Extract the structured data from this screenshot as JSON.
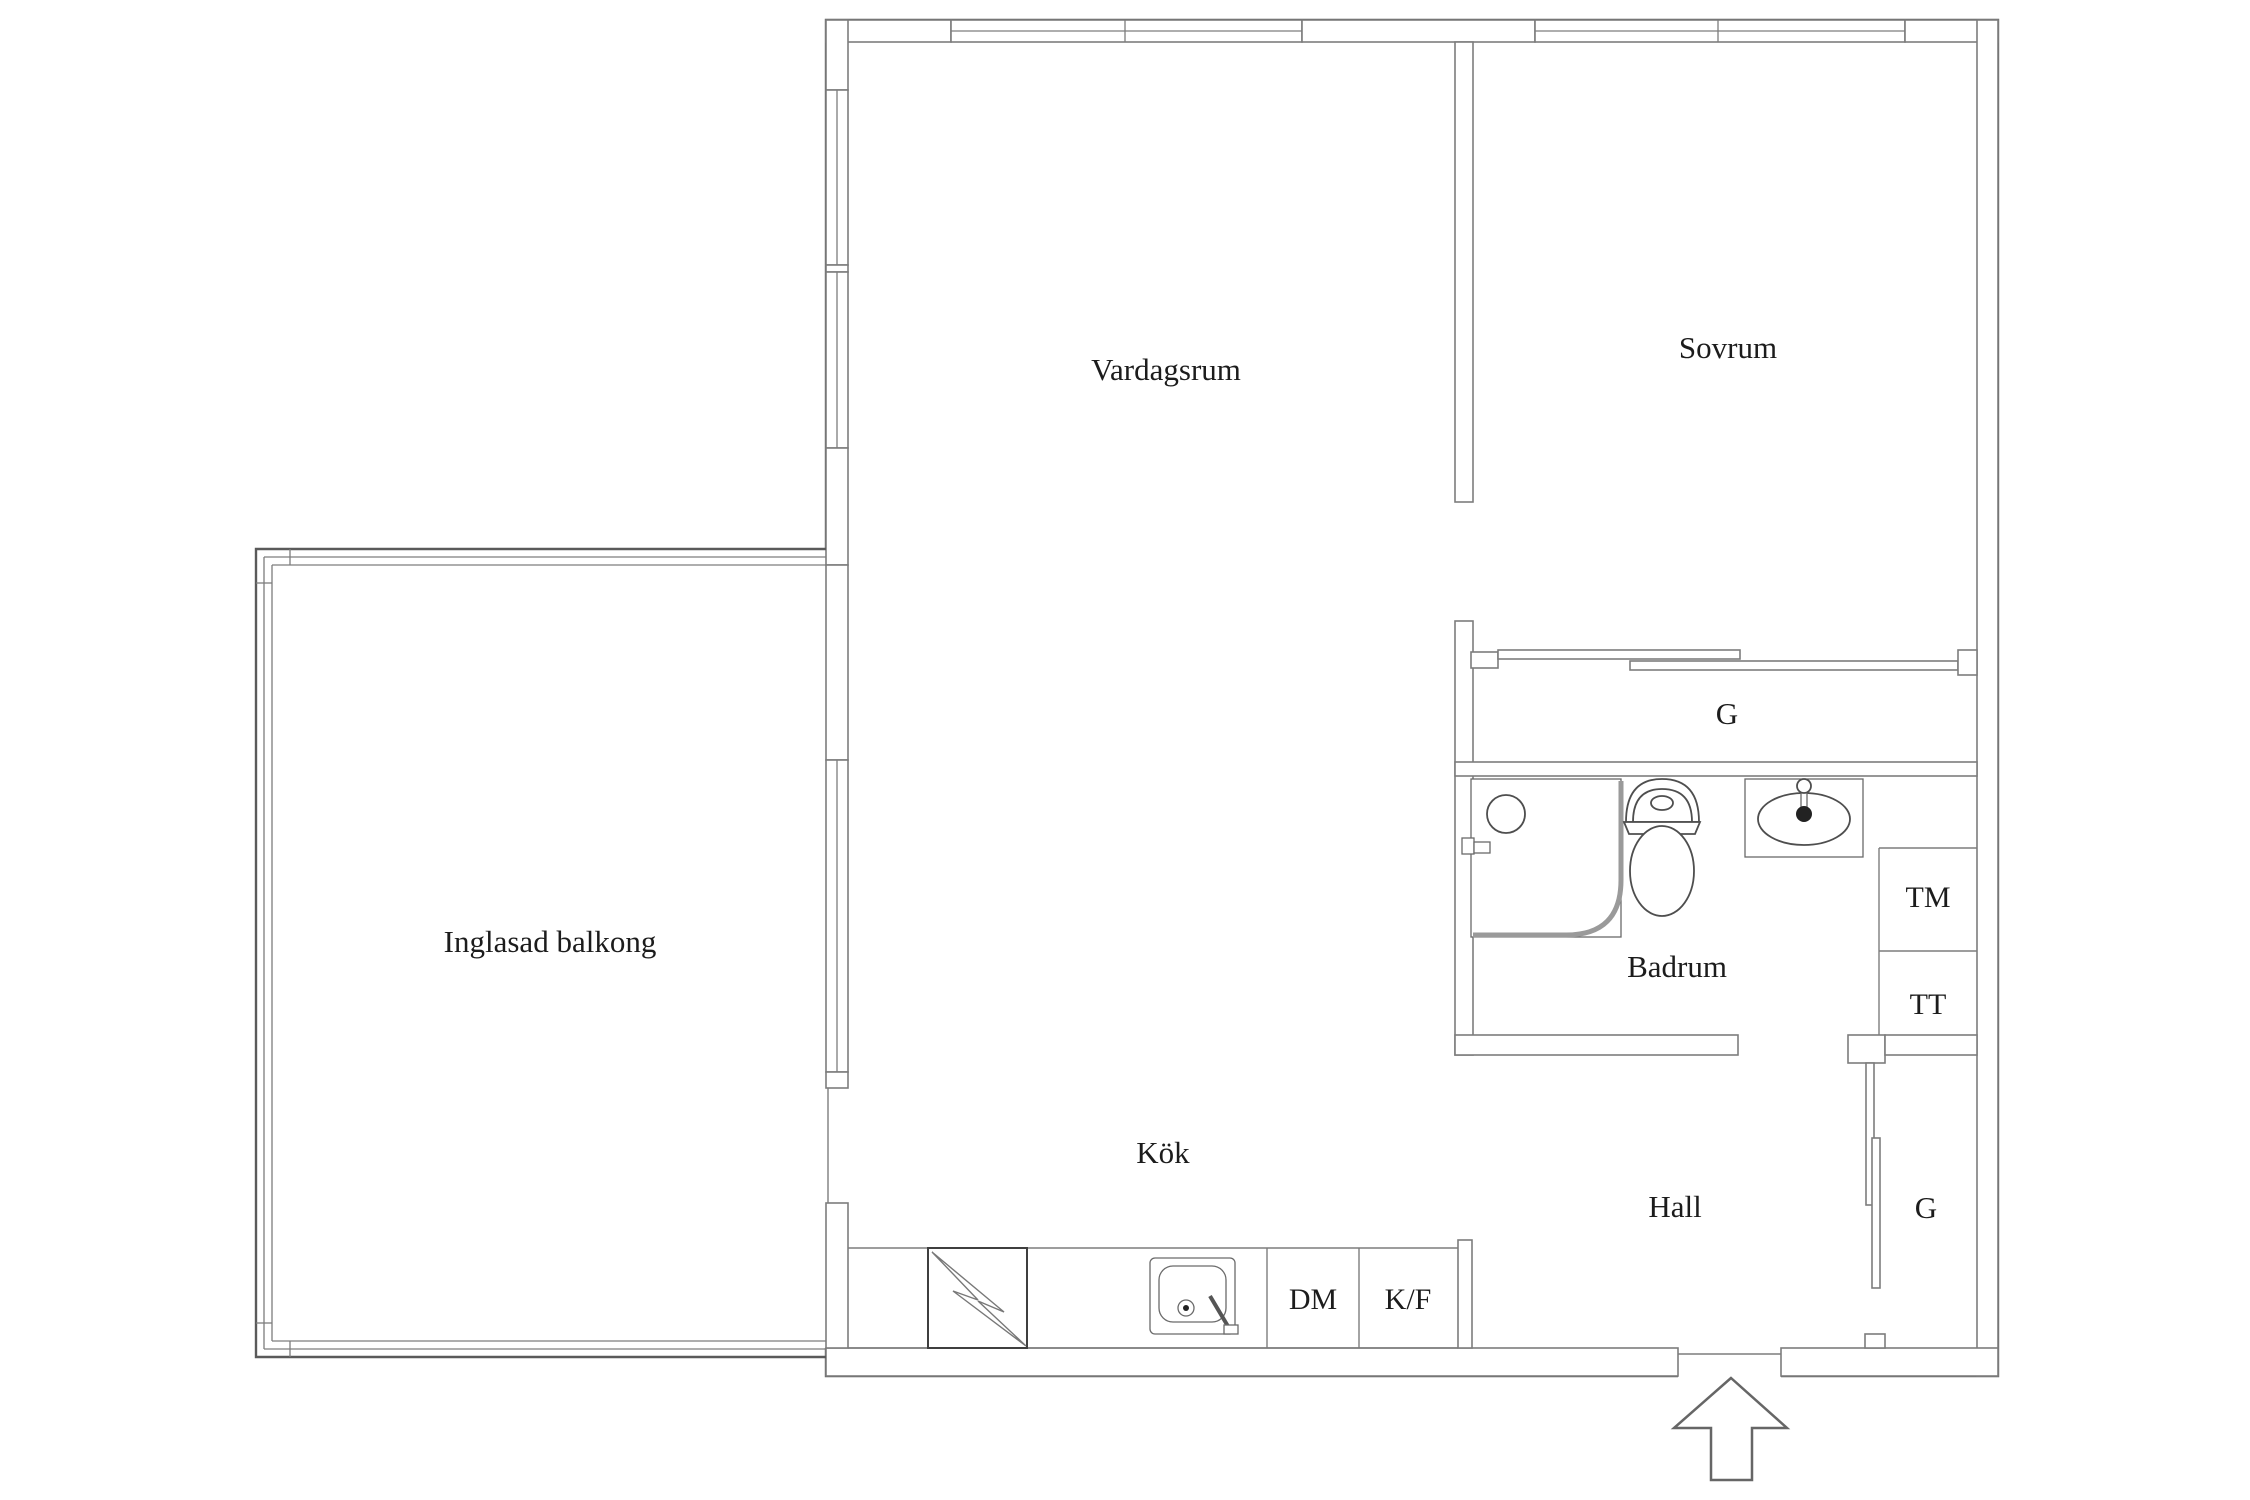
{
  "plan": {
    "rooms": {
      "living": "Vardagssrum_placeholder",
      "bedroom": "Sovrum",
      "balcony": "Inglasad balkong",
      "kitchen": "Kök",
      "bathroom": "Badrum",
      "hall": "Hall"
    },
    "storage": {
      "closet_top": "G",
      "closet_hall": "G"
    },
    "appliances": {
      "washing_machine": "TM",
      "tumble_dryer": "TT",
      "dishwasher": "DM",
      "fridge_freezer": "K/F"
    },
    "icons": {
      "entrance_arrow": "entrance-arrow-icon",
      "stove": "stove-lightning-icon",
      "kitchen_sink": "kitchen-sink-icon",
      "shower": "shower-icon",
      "toilet": "toilet-icon",
      "washbasin": "washbasin-icon"
    },
    "colors": {
      "wall": "#7d7d7d",
      "wall_dark": "#5a5a5a",
      "text": "#1c1c1c",
      "bg": "#ffffff"
    }
  }
}
